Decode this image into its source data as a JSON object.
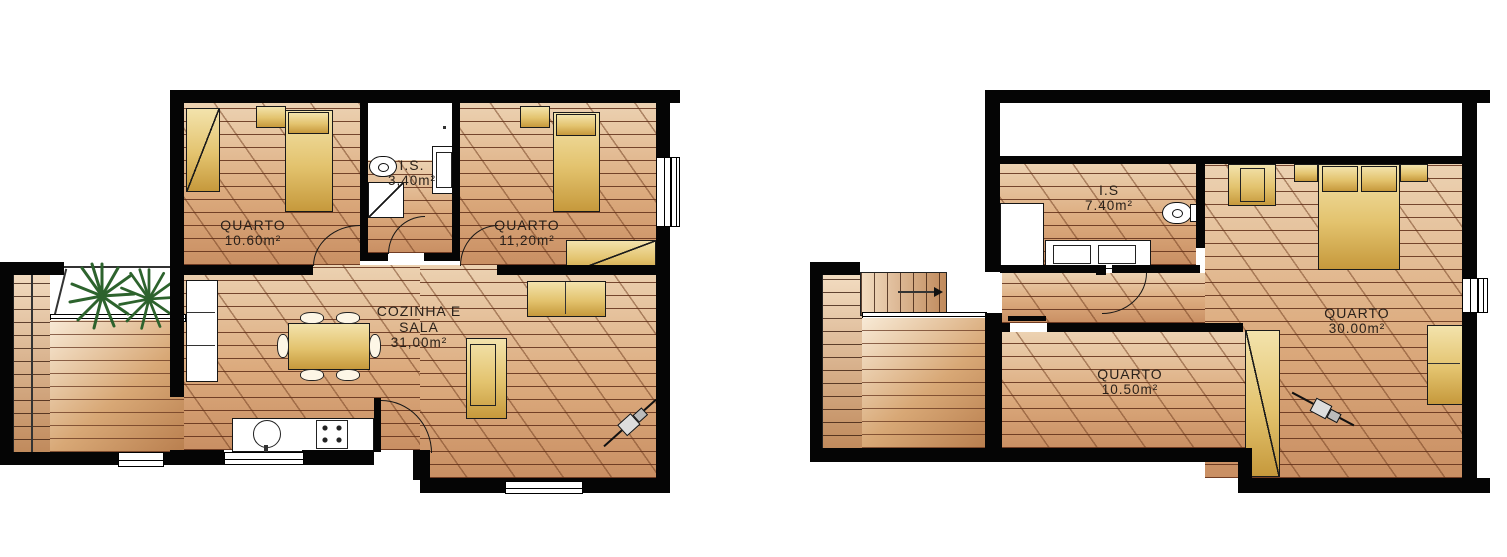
{
  "plans": {
    "left": {
      "quarto1": {
        "label": "QUARTO",
        "area": "10.60m²"
      },
      "is": {
        "label": "I.S.",
        "area": "3,40m²"
      },
      "quarto2": {
        "label": "QUARTO",
        "area": "11,20m²"
      },
      "cozinha": {
        "label": "COZINHA E SALA",
        "area": "31,00m²"
      }
    },
    "right": {
      "is": {
        "label": "I.S",
        "area": "7.40m²"
      },
      "quarto3": {
        "label": "QUARTO",
        "area": "30.00m²"
      },
      "quarto4": {
        "label": "QUARTO",
        "area": "10.50m²"
      }
    }
  },
  "colors": {
    "wall": "#050505",
    "floor_light": "#ecd2b2",
    "floor_dark": "#c98f63",
    "plank_line": "#6e3c22",
    "furniture_light": "#f3e3ac",
    "furniture_dark": "#c6993c",
    "plant_green": "#2d632d",
    "label_text": "#2a211a"
  },
  "icons": {
    "plant": "palm-plant-top-view",
    "toilet": "toilet-top-view",
    "sink": "round-kitchen-sink",
    "stove": "four-burner-stove",
    "stairs_arrow": "stairs-direction-arrow"
  }
}
